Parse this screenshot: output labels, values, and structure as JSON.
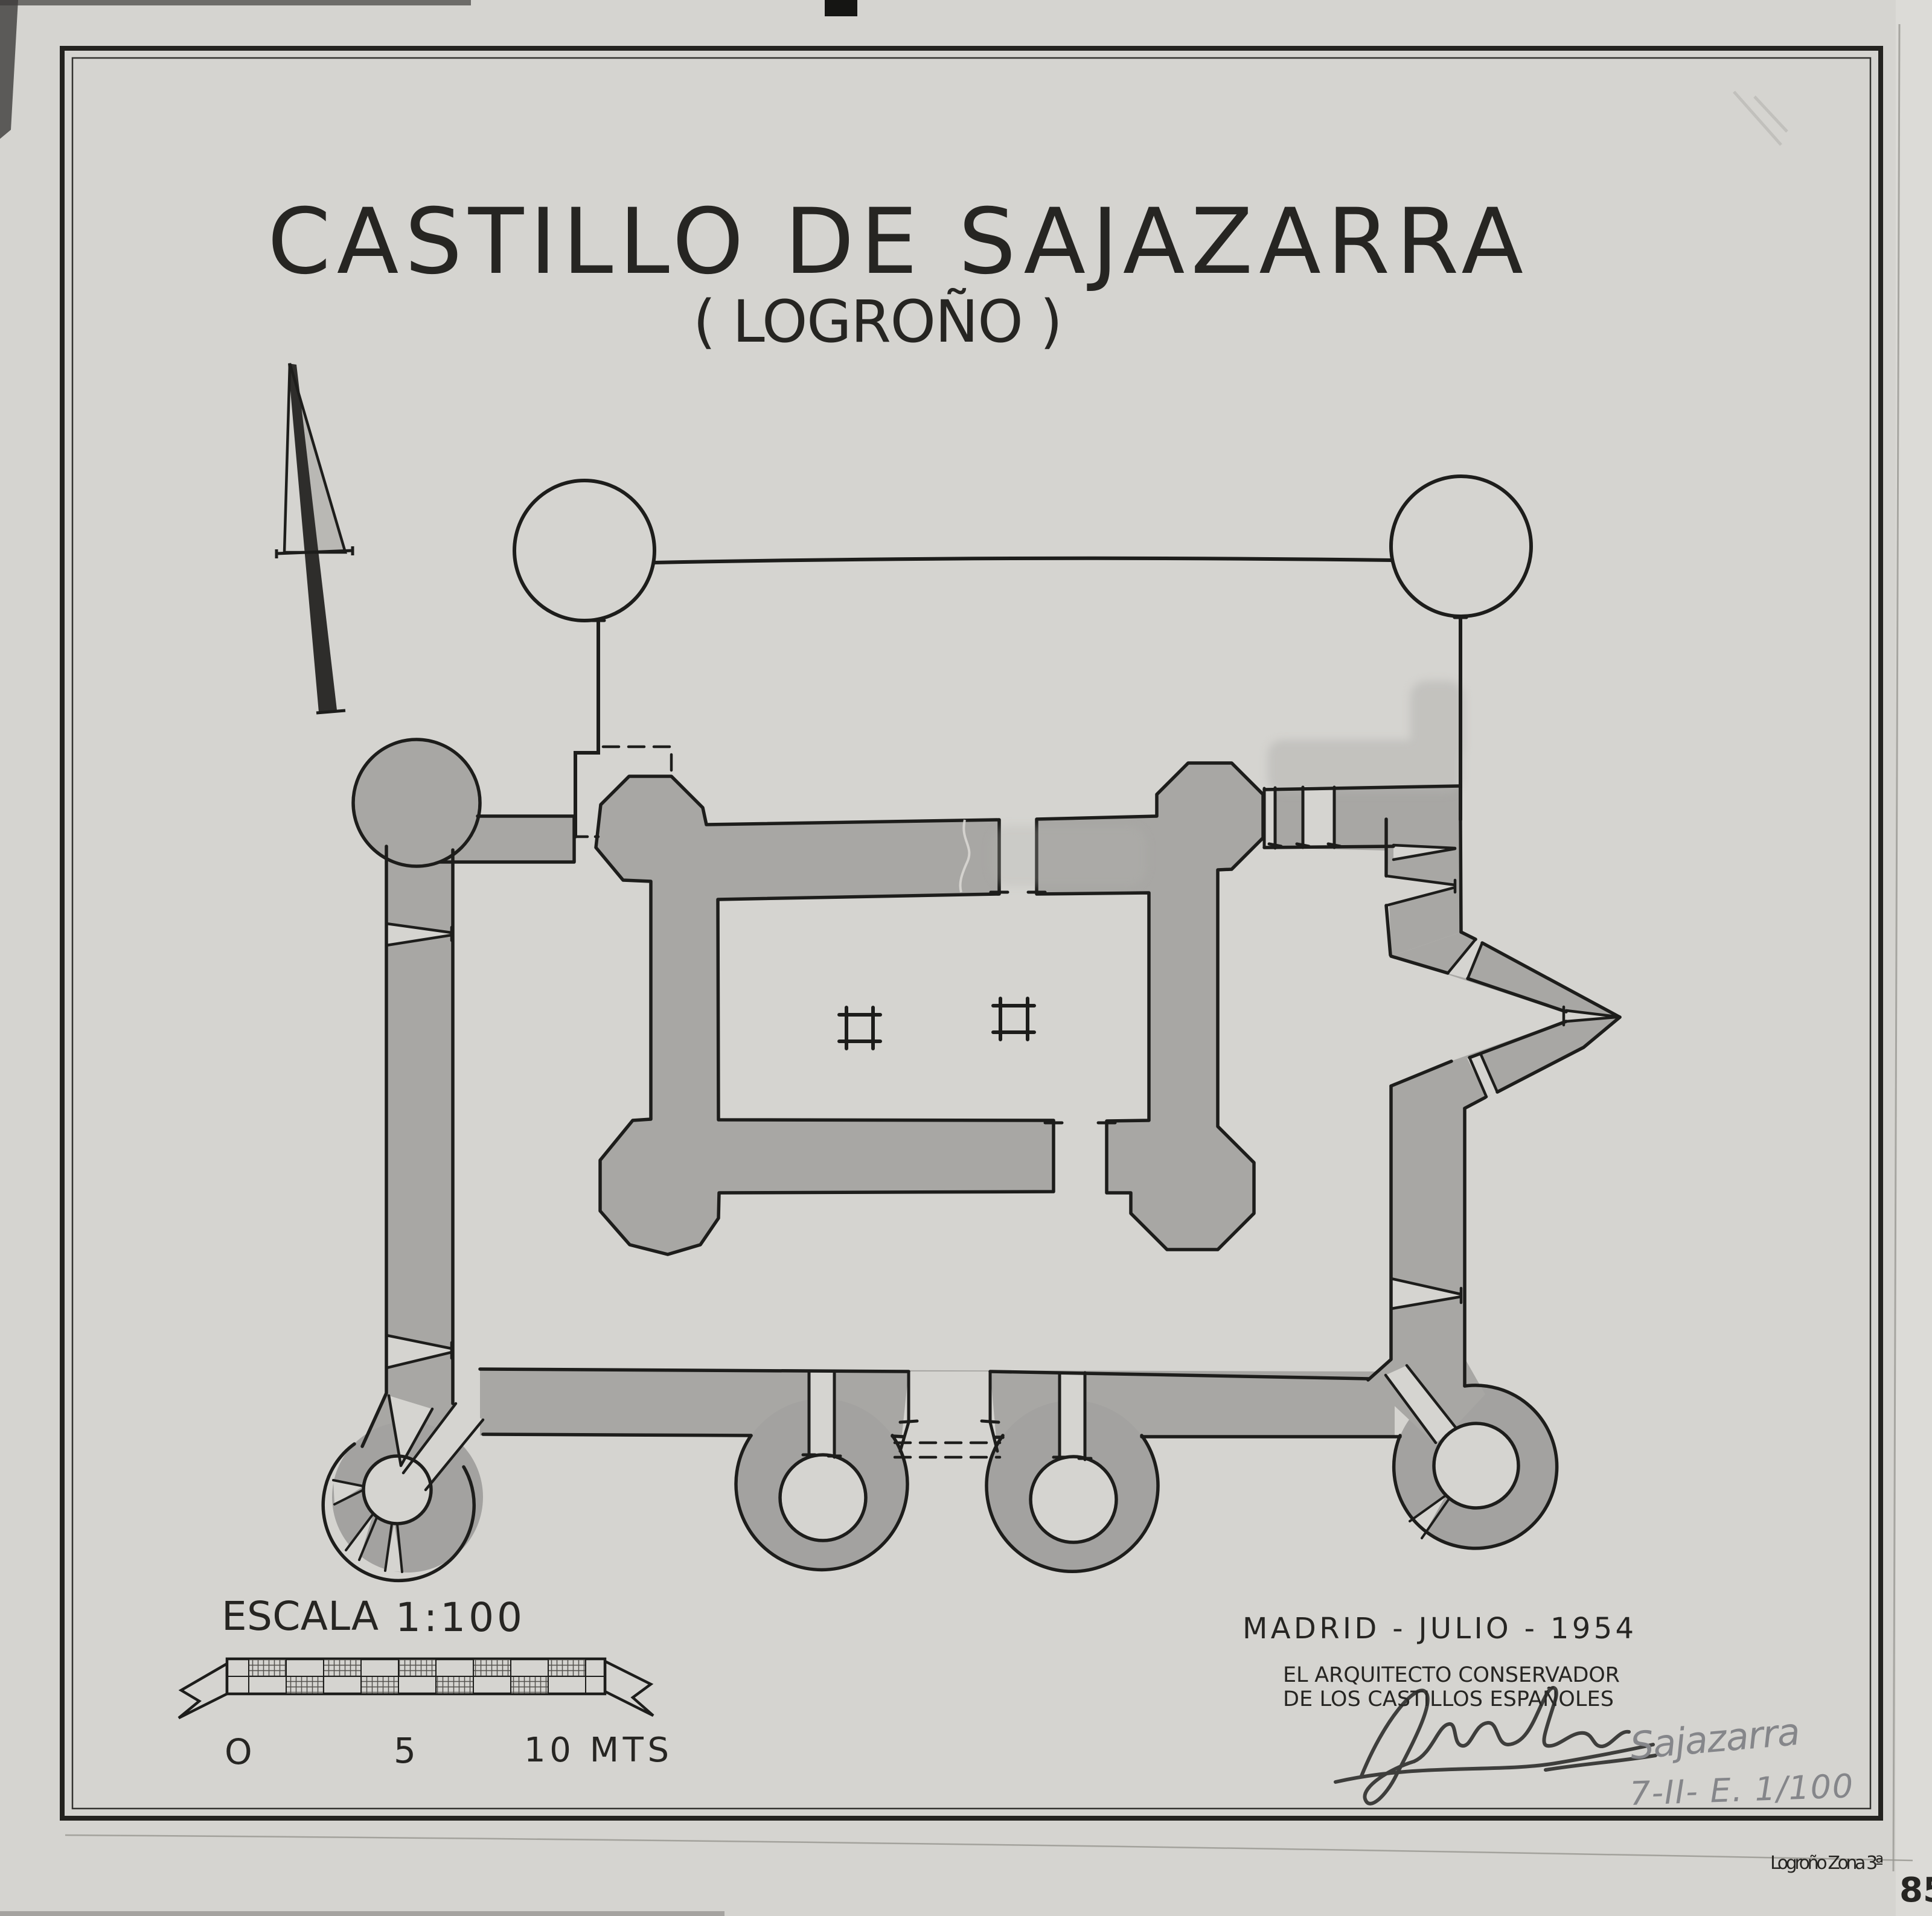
{
  "sheet": {
    "title": "CASTILLO DE SAJAZARRA",
    "subtitle": "( LOGROÑO )",
    "scale": {
      "escala_label": "ESCALA",
      "ratio": "1:100",
      "tick_0": "O",
      "tick_5": "5",
      "tick_10": "10 MTS"
    },
    "colophon": {
      "place_date": "MADRID - JULIO - 1954",
      "architect_line1": "EL ARQUITECTO CONSERVADOR",
      "architect_line2": "DE LOS CASTILLOS ESPAÑOLES"
    },
    "annotations": {
      "pencil_name": "Sajazarra",
      "pencil_ref": "7-II- E. 1/100",
      "margin_note": "Logroño  Zona 3ª",
      "page_number": "85"
    },
    "colors": {
      "paper": "#d5d4d0",
      "ink": "#1d1d1b",
      "wall_fill": "#a8a7a4",
      "wash": "#b4b3b0",
      "pencil": "#85868a"
    }
  }
}
